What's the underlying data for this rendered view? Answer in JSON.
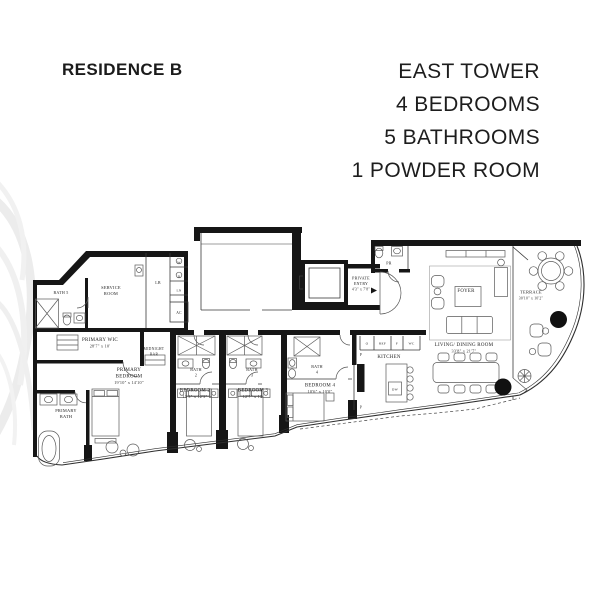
{
  "header": {
    "title": "RESIDENCE B",
    "lines": [
      "EAST TOWER",
      "4 BEDROOMS",
      "5 BATHROOMS",
      "1 POWDER ROOM"
    ]
  },
  "plan": {
    "bath5": "BATH 5",
    "service_room": [
      "SERVICE",
      "ROOM"
    ],
    "lb": "LB",
    "washer": "W",
    "dryer": "D",
    "linen": "LN",
    "ac": "AC",
    "primary_wic": {
      "name": "PRIMARY WIC",
      "dim": "28'7\" x 10'"
    },
    "midnight_bar": [
      "MIDNIGHT",
      "BAR"
    ],
    "primary_bedroom": {
      "name1": "PRIMARY",
      "name2": "BEDROOM",
      "dim": "19'10\" x 14'10\""
    },
    "primary_bath": [
      "PRIMARY",
      "BATH"
    ],
    "bath2": [
      "BATH",
      "2"
    ],
    "bath3": [
      "BATH",
      "3"
    ],
    "bath4": [
      "BATH",
      "4"
    ],
    "bedroom2": {
      "name": "BEDROOM 2",
      "dim": "13'3\" x 12'3\""
    },
    "bedroom3": {
      "name": "BEDROOM 3",
      "dim": "12'7\" x 12'"
    },
    "bedroom4": {
      "name": "BEDROOM 4",
      "dim": "10'6\" x 10'0\""
    },
    "private_entry": {
      "name1": "PRIVATE",
      "name2": "ENTRY",
      "dim": "4'3\" x 7'8\""
    },
    "powder_room": "PR",
    "foyer": "FOYER",
    "kitchen": {
      "name": "KITCHEN",
      "oven": "O",
      "fridge": "REF",
      "freezer": "F",
      "wine": "WC",
      "pantry": "P",
      "dishwasher": "DW"
    },
    "living_dining": {
      "name": "LIVING/ DINING ROOM",
      "dim": "33'8\" x 21'7\""
    },
    "terrace": {
      "name": "TERRACE",
      "dim": "30'10\" x 10'2\""
    }
  }
}
